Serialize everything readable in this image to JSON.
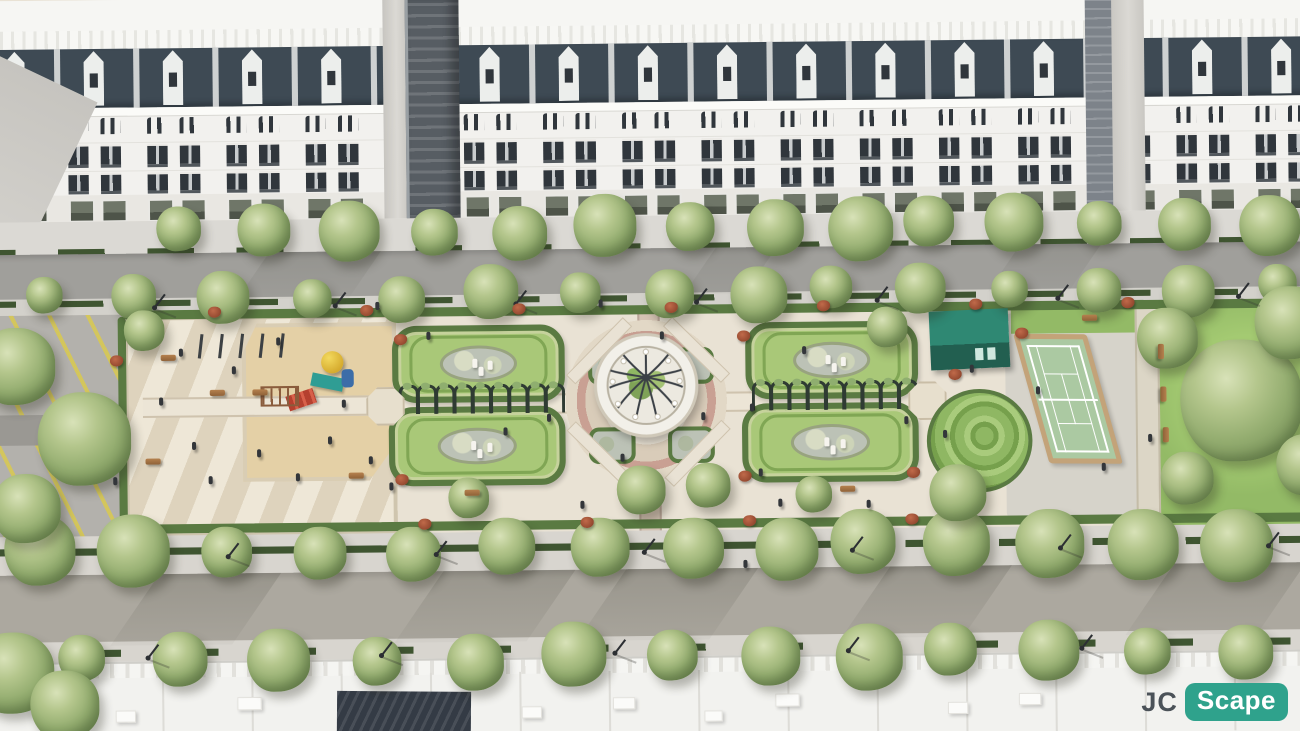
{
  "watermark": {
    "prefix": "JC",
    "badge": "Scape"
  },
  "scene": {
    "description": "Aerial 3D render of a linear French-formal park boulevard between rows of white neoclassical shophouses with mansard roofs; park contains a parking court, paved playground plaza, twin oval parterre gardens with pergolas, a central white domed gazebo on a circular plaza, a teal garden kiosk with spiral lawn, a tennis court and tree-dotted lawns, framed by tree-lined streets and rooftops in the foreground",
    "palette": {
      "building_white": "#f2f1ee",
      "mansard_roof": "#3e4a54",
      "window": "#30363c",
      "road": "#a09f9b",
      "sidewalk": "#d8d5cf",
      "park_paving": "#e9e2d4",
      "lawn": "#93ba66",
      "hedge": "#5a7a42",
      "parterre_lawn": "#a9c878",
      "flower_bed": "#bcc2b6",
      "path_pink": "#c9a093",
      "sand": "#e4d0a6",
      "tree": "#8aa268",
      "tennis_court": "#abc9a2",
      "court_border": "#c3a379",
      "kiosk_teal": "#2e7b69",
      "parking_stripe": "#d9c94f",
      "shrub_red": "#a8543c",
      "logo_teal": "#2fa28c",
      "logo_gray": "#4b5258"
    },
    "counts": {
      "building_modules": 17,
      "pergola_arches": 9,
      "people": 34
    },
    "tree_rows": [
      {
        "y": 230,
        "start": 195,
        "gap": 82,
        "count": 14,
        "rmin": 22,
        "rmax": 32
      },
      {
        "y": 294,
        "start": 62,
        "gap": 86,
        "count": 15,
        "rmin": 18,
        "rmax": 28
      },
      {
        "y": 545,
        "start": 55,
        "gap": 90,
        "count": 14,
        "rmin": 25,
        "rmax": 36
      },
      {
        "y": 652,
        "start": 95,
        "gap": 95,
        "count": 13,
        "rmin": 23,
        "rmax": 33
      }
    ],
    "park_trees": [
      [
        26,
        360,
        38
      ],
      [
        92,
        432,
        46
      ],
      [
        34,
        500,
        34
      ],
      [
        152,
        326,
        20
      ],
      [
        1232,
        406,
        60
      ],
      [
        1160,
        344,
        30
      ],
      [
        1282,
        330,
        36
      ],
      [
        1296,
        470,
        30
      ],
      [
        1178,
        482,
        26
      ],
      [
        952,
        494,
        28
      ],
      [
        640,
        488,
        24
      ],
      [
        706,
        484,
        22
      ],
      [
        884,
        330,
        20
      ],
      [
        470,
        494,
        20
      ],
      [
        810,
        494,
        18
      ],
      [
        20,
        662,
        40
      ],
      [
        70,
        694,
        34
      ]
    ],
    "lamp_rows": [
      {
        "y": 301,
        "start": 160,
        "gap": 178,
        "count": 7
      },
      {
        "y": 547,
        "start": 230,
        "gap": 205,
        "count": 6
      },
      {
        "y": 646,
        "start": 150,
        "gap": 230,
        "count": 5
      }
    ],
    "people": [
      [
        166,
        392
      ],
      [
        198,
        436
      ],
      [
        238,
        362
      ],
      [
        262,
        444
      ],
      [
        300,
        468
      ],
      [
        332,
        432
      ],
      [
        346,
        396
      ],
      [
        214,
        470
      ],
      [
        186,
        344
      ],
      [
        282,
        334
      ],
      [
        372,
        452
      ],
      [
        392,
        478
      ],
      [
        430,
        330
      ],
      [
        505,
        425
      ],
      [
        548,
        412
      ],
      [
        620,
        452
      ],
      [
        700,
        412
      ],
      [
        748,
        404
      ],
      [
        756,
        468
      ],
      [
        800,
        348
      ],
      [
        862,
        500
      ],
      [
        900,
        418
      ],
      [
        938,
        432
      ],
      [
        660,
        332
      ],
      [
        580,
        498
      ],
      [
        1030,
        390
      ],
      [
        1094,
        466
      ],
      [
        1140,
        438
      ],
      [
        120,
        470
      ],
      [
        775,
        498
      ],
      [
        965,
        368
      ],
      [
        740,
        558
      ],
      [
        600,
        300
      ],
      [
        380,
        300
      ]
    ],
    "benches": [
      [
        168,
        350,
        0
      ],
      [
        216,
        385,
        0
      ],
      [
        258,
        385,
        0
      ],
      [
        152,
        452,
        0
      ],
      [
        352,
        468,
        0
      ],
      [
        1076,
        320,
        0
      ],
      [
        1146,
        354,
        90
      ],
      [
        1148,
        396,
        90
      ],
      [
        1150,
        436,
        90
      ],
      [
        466,
        486,
        0
      ],
      [
        836,
        486,
        0
      ]
    ],
    "shrub_rows": [
      {
        "y": 303,
        "start": 215,
        "gap": 150,
        "count": 7
      },
      {
        "y": 514,
        "start": 420,
        "gap": 160,
        "count": 4
      }
    ],
    "shrub_extra": [
      [
        1010,
        332
      ],
      [
        944,
        372
      ],
      [
        902,
        468
      ],
      [
        118,
        350
      ],
      [
        398,
        332
      ],
      [
        736,
        332
      ],
      [
        398,
        470
      ],
      [
        736,
        470
      ]
    ],
    "parterres": [
      [
        396,
        324,
        158,
        64
      ],
      [
        392,
        404,
        162,
        66
      ],
      [
        744,
        324,
        158,
        64
      ],
      [
        740,
        404,
        162,
        66
      ]
    ],
    "pergolas": [
      {
        "x": 402,
        "y": 382,
        "gap": 18
      },
      {
        "x": 750,
        "y": 382,
        "gap": 18
      }
    ],
    "corner_beds": [
      [
        589,
        348
      ],
      [
        667,
        348
      ],
      [
        589,
        426
      ],
      [
        667,
        426
      ]
    ],
    "diag_paths": [
      [
        560,
        344,
        -45
      ],
      [
        656,
        344,
        45
      ],
      [
        560,
        446,
        45
      ],
      [
        656,
        446,
        -45
      ]
    ],
    "octagons": [
      [
        370,
        384
      ],
      [
        904,
        384
      ]
    ],
    "swing_posts": {
      "x": 206,
      "y": 330,
      "gap": 20,
      "count": 5
    },
    "road_shadows_s": [
      140,
      420,
      600,
      860,
      1140
    ],
    "road_shadows_n": [
      260,
      700,
      1000
    ],
    "roof_units": [
      [
        240,
        688,
        22,
        11
      ],
      [
        520,
        700,
        18,
        10
      ],
      [
        610,
        692,
        20,
        10
      ],
      [
        700,
        706,
        16,
        9
      ],
      [
        770,
        690,
        22,
        11
      ],
      [
        940,
        700,
        18,
        10
      ],
      [
        1010,
        692,
        20,
        10
      ],
      [
        120,
        700,
        18,
        10
      ]
    ]
  }
}
